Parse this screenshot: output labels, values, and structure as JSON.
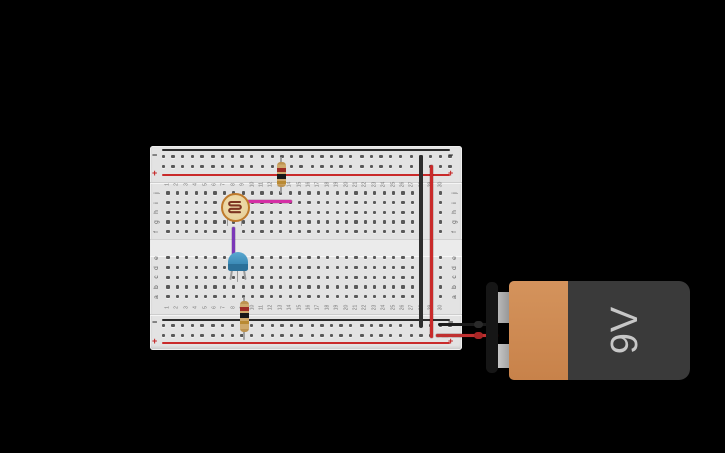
{
  "app": {
    "canvas_bg": "#000000"
  },
  "breadboard": {
    "row_letters_top": [
      "j",
      "i",
      "h",
      "g",
      "f"
    ],
    "row_letters_bottom": [
      "e",
      "d",
      "c",
      "b",
      "a"
    ],
    "column_numbers": [
      "1",
      "2",
      "3",
      "4",
      "5",
      "6",
      "7",
      "8",
      "9",
      "10",
      "11",
      "12",
      "13",
      "14",
      "15",
      "16",
      "17",
      "18",
      "19",
      "20",
      "21",
      "22",
      "23",
      "24",
      "25",
      "26",
      "27",
      "28",
      "29",
      "30"
    ],
    "rail_labels": {
      "minus": "−",
      "plus": "+"
    },
    "colors": {
      "board": "#e3e3e3",
      "hole": "#595959",
      "line_black": "#2b2b2b",
      "line_red": "#c92a2a",
      "minus_text": "#222222",
      "plus_text": "#c42222"
    }
  },
  "components": {
    "battery": {
      "label": "9V",
      "body_color": "#3a3a3a",
      "cell_color": "#cf8a50"
    },
    "photoresistor": {
      "body_color": "#ecd9a8",
      "ring_color": "#bf7a2c",
      "track_color": "#7d3522"
    },
    "transistor": {
      "body_color": "#3d8cb8",
      "band_color": "#2b7099"
    },
    "resistor_top": {
      "body_color": "#cfa96b",
      "band_colors": [
        "#9e2b25",
        "#181818",
        "#b98a33"
      ]
    },
    "resistor_bottom": {
      "body_color": "#cfa96b",
      "band_colors": [
        "#9e2b25",
        "#181818",
        "#b98a33"
      ]
    },
    "wires": {
      "negative_rail_jumper": "#2e2e2e",
      "positive_rail_jumper": "#c92a2a",
      "ldr_output_pink": "#d42fa5",
      "transistor_base_purple": "#7b37b8",
      "battery_negative_lead": "#1b1b1b",
      "battery_positive_lead": "#c03030"
    }
  }
}
